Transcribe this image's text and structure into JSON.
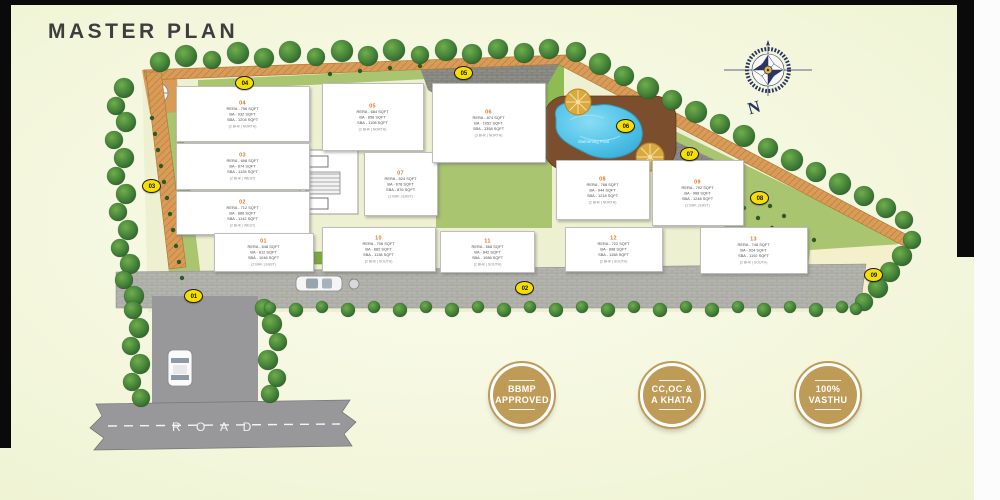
{
  "title": "MASTER PLAN",
  "compass": {
    "label": "N"
  },
  "road_label": "R O A D",
  "pool_label": "Swimming Pool",
  "badges": [
    {
      "line1": "BBMP",
      "line2": "APPROVED"
    },
    {
      "line1": "CC,OC &",
      "line2": "A KHATA"
    },
    {
      "line1": "100%",
      "line2": "VASTHU"
    }
  ],
  "markers": [
    {
      "id": "01"
    },
    {
      "id": "02"
    },
    {
      "id": "03"
    },
    {
      "id": "04"
    },
    {
      "id": "05"
    },
    {
      "id": "06"
    },
    {
      "id": "07"
    },
    {
      "id": "08"
    },
    {
      "id": "09"
    }
  ],
  "colors": {
    "accent_orange": "#e0762a",
    "marker_yellow": "#f6de00",
    "badge_gold": "#bf9b58",
    "track_tan": "#d99c58",
    "lawn_green": "#a9c56f",
    "pool_blue": "#4fc2e8",
    "road_gray": "#98989a"
  },
  "units": [
    {
      "number": "04",
      "lines": [
        "RERA - 756 SQFT",
        "BA - 932 SQFT",
        "SBA - 1204 SQFT"
      ],
      "config": "(2 BHK | NORTH)"
    },
    {
      "number": "03",
      "lines": [
        "RERA - 698 SQFT",
        "BA - 874 SQFT",
        "SBA - 1128 SQFT"
      ],
      "config": "(2 BHK | WEST)"
    },
    {
      "number": "02",
      "lines": [
        "RERA - 712 SQFT",
        "BA - 886 SQFT",
        "SBA - 1142 SQFT"
      ],
      "config": "(2 BHK | WEST)"
    },
    {
      "number": "01",
      "lines": [
        "RERA - 648 SQFT",
        "BA - 812 SQFT",
        "SBA - 1046 SQFT"
      ],
      "config": "(2 BHK | EAST)"
    },
    {
      "number": "05",
      "lines": [
        "RERA - 684 SQFT",
        "BA - 858 SQFT",
        "SBA - 1108 SQFT"
      ],
      "config": "(2 BHK | NORTH)"
    },
    {
      "number": "07",
      "lines": [
        "RERA - 524 SQFT",
        "BA - 678 SQFT",
        "SBA - 876 SQFT"
      ],
      "config": "(1 BHK | EAST)"
    },
    {
      "number": "06",
      "lines": [
        "RERA - 874 SQFT",
        "BA - 1052 SQFT",
        "SBA - 1358 SQFT"
      ],
      "config": "(3 BHK | NORTH)"
    },
    {
      "number": "08",
      "lines": [
        "RERA - 768 SQFT",
        "BA - 944 SQFT",
        "SBA - 1218 SQFT"
      ],
      "config": "(2 BHK | NORTH)"
    },
    {
      "number": "09",
      "lines": [
        "RERA - 792 SQFT",
        "BA - 968 SQFT",
        "SBA - 1248 SQFT"
      ],
      "config": "(2 BHK | EAST)"
    },
    {
      "number": "10",
      "lines": [
        "RERA - 706 SQFT",
        "BA - 882 SQFT",
        "SBA - 1138 SQFT"
      ],
      "config": "(2 BHK | SOUTH)"
    },
    {
      "number": "11",
      "lines": [
        "RERA - 668 SQFT",
        "BA - 842 SQFT",
        "SBA - 1086 SQFT"
      ],
      "config": "(2 BHK | SOUTH)"
    },
    {
      "number": "12",
      "lines": [
        "RERA - 722 SQFT",
        "BA - 898 SQFT",
        "SBA - 1158 SQFT"
      ],
      "config": "(2 BHK | SOUTH)"
    },
    {
      "number": "13",
      "lines": [
        "RERA - 748 SQFT",
        "BA - 924 SQFT",
        "SBA - 1192 SQFT"
      ],
      "config": "(2 BHK | SOUTH)"
    }
  ]
}
